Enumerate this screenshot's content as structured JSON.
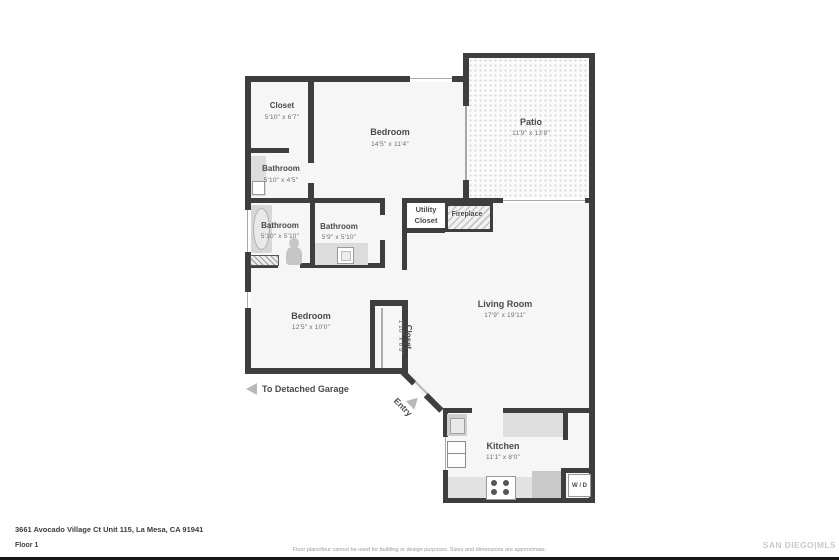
{
  "rooms": {
    "closet_top": {
      "name": "Closet",
      "dims": "5'10\" x 6'7\""
    },
    "bedroom_top": {
      "name": "Bedroom",
      "dims": "14'5\" x 11'4\""
    },
    "patio": {
      "name": "Patio",
      "dims": "11'9\" x 13'8\""
    },
    "bathroom_top": {
      "name": "Bathroom",
      "dims": "5'10\" x 4'5\""
    },
    "bathroom_left": {
      "name": "Bathroom",
      "dims": "5'10\" x 5'10\""
    },
    "bathroom_right": {
      "name": "Bathroom",
      "dims": "5'9\" x 5'10\""
    },
    "utility": {
      "name": "Utility Closet"
    },
    "fireplace": {
      "name": "Fireplace"
    },
    "living": {
      "name": "Living Room",
      "dims": "17'9\" x 19'11\""
    },
    "bedroom_bottom": {
      "name": "Bedroom",
      "dims": "12'5\" x 10'0\""
    },
    "closet_bottom": {
      "name": "Closet",
      "dims": "1'10\" x 6'9\""
    },
    "kitchen": {
      "name": "Kitchen",
      "dims": "11'1\" x 8'0\""
    },
    "wd": {
      "name": "W / D"
    }
  },
  "annotations": {
    "garage": "To Detached Garage",
    "entry": "Entry"
  },
  "footer": {
    "address": "3661 Avocado Village Ct Unit 115, La Mesa, CA 91941",
    "floor": "Floor 1",
    "disclaimer": "Floor plans/tour cannot be used for building or design purposes. Sizes and dimensions are approximate.",
    "logo": "SAN DIEGO|MLS"
  },
  "colors": {
    "wall": "#3e3e3e",
    "room_fill": "#f6f6f6",
    "label_text": "#4a4a4a"
  }
}
